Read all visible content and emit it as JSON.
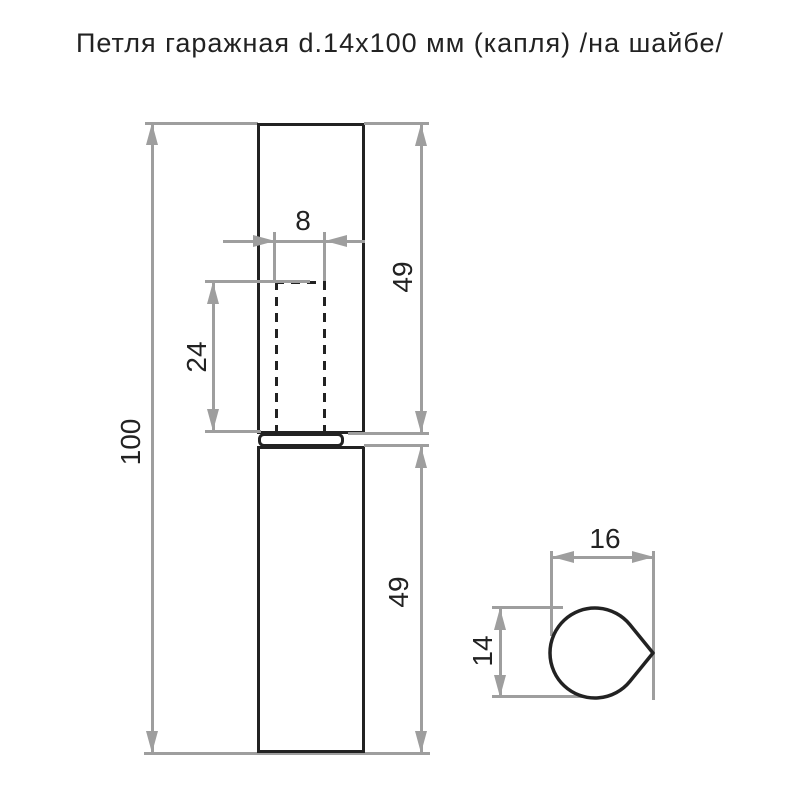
{
  "title": "Петля гаражная d.14x100 мм (капля) /на шайбе/",
  "colors": {
    "line": "#222222",
    "dimension": "#9e9e9e",
    "background": "#ffffff"
  },
  "front_view": {
    "dims": {
      "total_height": "100",
      "pin_diameter": "8",
      "pin_hole_depth": "24",
      "upper_leaf_height": "49",
      "lower_leaf_height": "49"
    }
  },
  "section_view": {
    "dims": {
      "profile_width": "16",
      "profile_height": "14"
    }
  }
}
